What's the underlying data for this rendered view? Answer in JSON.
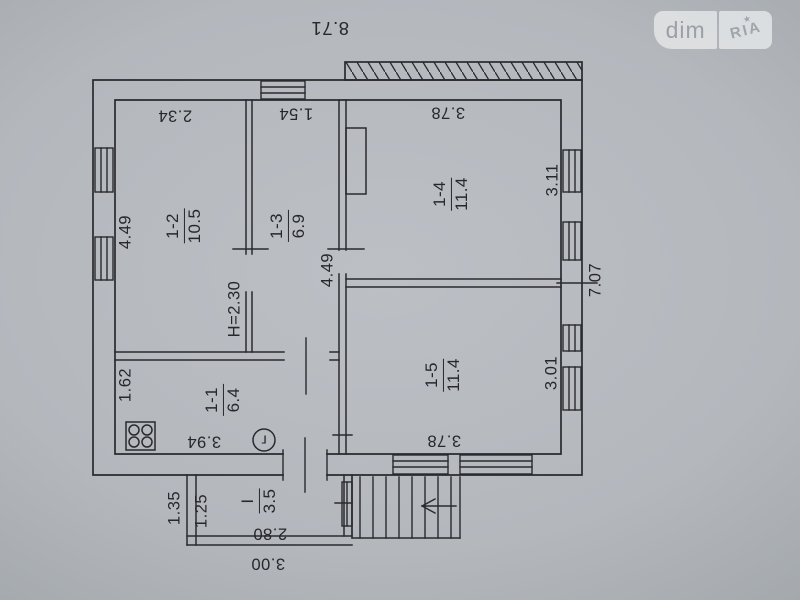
{
  "watermark": {
    "dim": "dim",
    "ria": "RIA",
    "star": "★"
  },
  "dims": {
    "total_width_top": "8.71",
    "room_1_2_width": "2.34",
    "room_1_3_width": "1.54",
    "room_1_4_width": "3.78",
    "room_1_4_height": "3.11",
    "total_height_right": "7.07",
    "room_1_5_height": "3.01",
    "room_1_2_height": "4.49",
    "hall_height": "4.49",
    "ceiling_height": "H=2.30",
    "kitchen_width": "3.94",
    "kitchen_depth": "1.62",
    "room_1_5_width": "3.78",
    "porch_depth_outer": "1.35",
    "porch_depth_inner": "1.25",
    "porch_width_inner": "2.80",
    "porch_width_outer": "3.00"
  },
  "rooms": {
    "r12": {
      "num": "1-2",
      "area": "10.5"
    },
    "r13": {
      "num": "1-3",
      "area": "6.9"
    },
    "r14": {
      "num": "1-4",
      "area": "11.4"
    },
    "r15": {
      "num": "1-5",
      "area": "11.4"
    },
    "r11": {
      "num": "1-1",
      "area": "6.4"
    },
    "porch": {
      "num": "I",
      "area": "3.5"
    }
  },
  "icons": {
    "gas_meter_letter": "г"
  },
  "colors": {
    "ink": "#2a2a2e",
    "paper": "#b4b8bd",
    "watermark_bg": "#dfe1e3",
    "watermark_text": "#9aa0a6"
  }
}
